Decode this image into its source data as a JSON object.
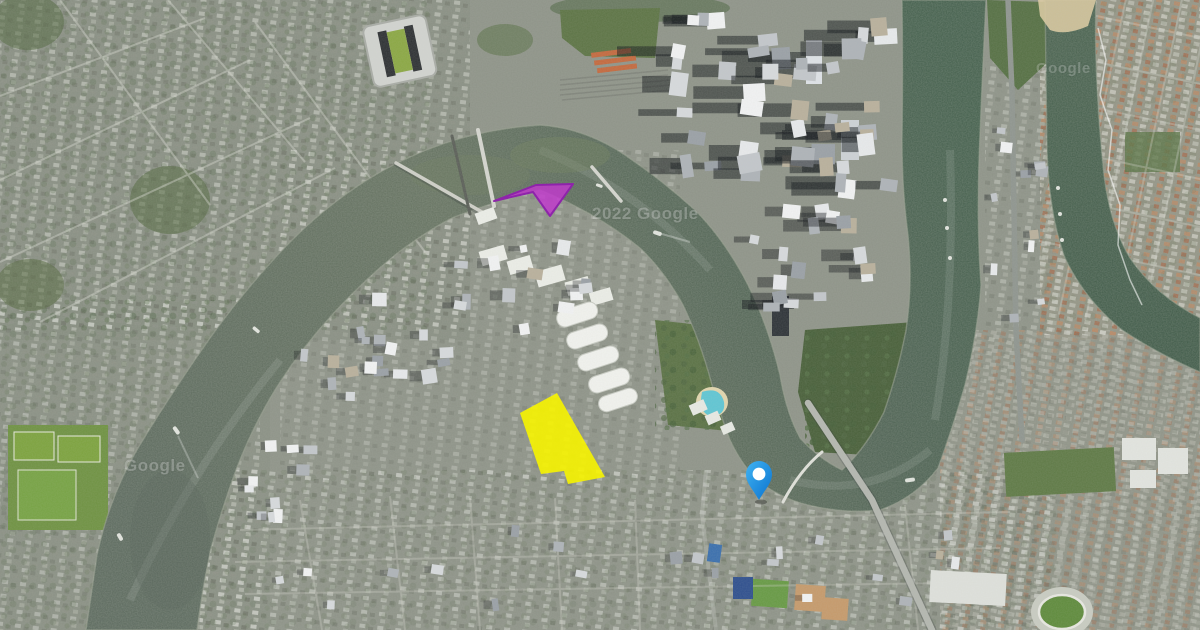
{
  "watermarks": {
    "center": "2022 Google",
    "top_right": "Google",
    "bottom_left": "Google"
  },
  "overlays": {
    "yellow_polygon": {
      "label": "highlighted-site-yellow",
      "points": [
        [
          557,
          393
        ],
        [
          605,
          477
        ],
        [
          568,
          484
        ],
        [
          564,
          471
        ],
        [
          541,
          474
        ],
        [
          520,
          413
        ]
      ],
      "fill": "#F7F400",
      "opacity": 0.9
    },
    "magenta_polygon": {
      "label": "highlighted-site-magenta",
      "points": [
        [
          494,
          201
        ],
        [
          536,
          185
        ],
        [
          573,
          184
        ],
        [
          550,
          216
        ],
        [
          533,
          192
        ]
      ],
      "fill": "#C238CE",
      "stroke": "#8E24AA",
      "opacity": 0.82
    },
    "pin": {
      "x": 759,
      "y": 500,
      "fill_top": "#41B3F2",
      "fill_bottom": "#0A72CF"
    }
  }
}
